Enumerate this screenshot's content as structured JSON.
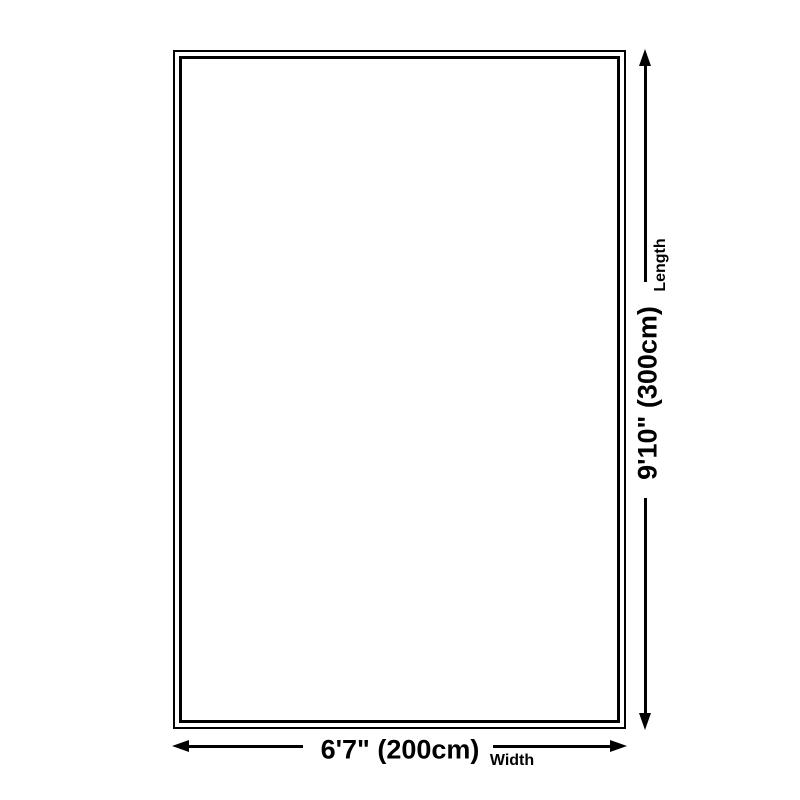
{
  "diagram": {
    "colors": {
      "background": "#ffffff",
      "line": "#000000",
      "text": "#000000"
    },
    "width_dimension": {
      "value": "6'7\" (200cm)",
      "label": "Width"
    },
    "length_dimension": {
      "value": "9'10\" (300cm)",
      "label": "Length"
    }
  }
}
